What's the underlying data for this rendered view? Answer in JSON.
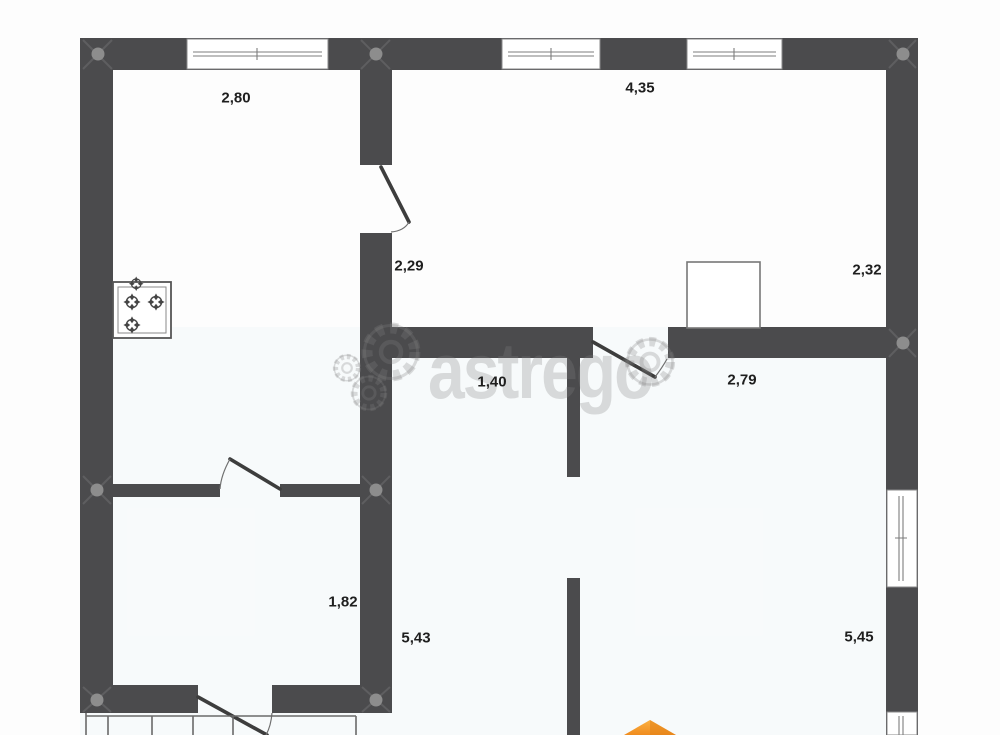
{
  "plan_title": "floor-plan",
  "watermark": {
    "text": "astrego"
  },
  "dimensions": [
    {
      "id": "2-80",
      "text": "2,80"
    },
    {
      "id": "4-35",
      "text": "4,35"
    },
    {
      "id": "2-29",
      "text": "2,29"
    },
    {
      "id": "2-32",
      "text": "2,32"
    },
    {
      "id": "1-40",
      "text": "1,40"
    },
    {
      "id": "2-79",
      "text": "2,79"
    },
    {
      "id": "1-82",
      "text": "1,82"
    },
    {
      "id": "5-43",
      "text": "5,43"
    },
    {
      "id": "5-45",
      "text": "5,45"
    }
  ],
  "icons": {
    "stove": "stove-burners-icon",
    "gears": "gear-icon",
    "logo_arrow": "orange-logo-arrow-icon"
  },
  "colors": {
    "wall": "#4b4b4d",
    "door": "#3d3d3d",
    "frame": "#8a8a8a",
    "dot": "#8d8d8d",
    "label": "#1e1e1e",
    "accent-orange": "#f49a26",
    "accent-orange-dark": "#e2831a",
    "background": "#fdfdfd"
  }
}
